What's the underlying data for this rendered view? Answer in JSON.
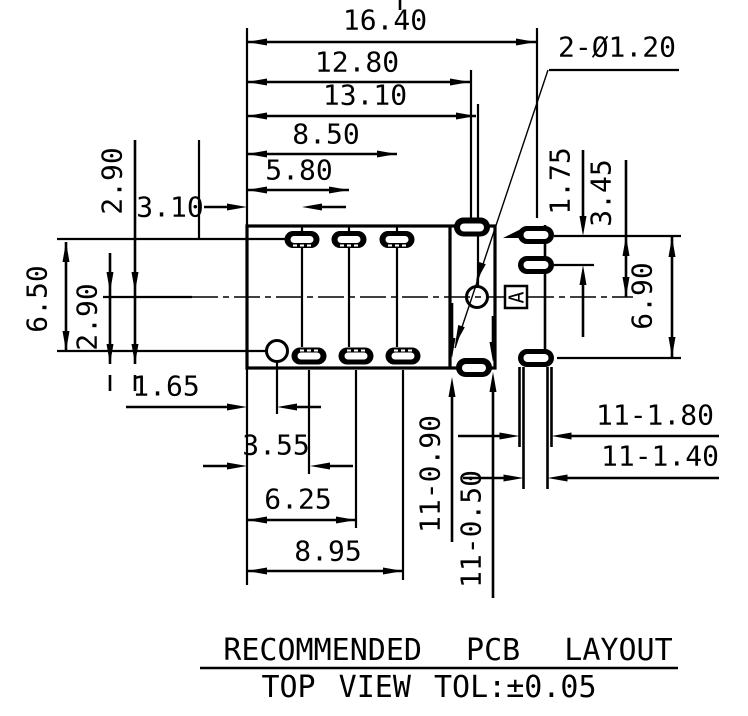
{
  "note": {
    "title": "RECOMMENDED PCB LAYOUT",
    "subtitle": "TOP VIEW TOL:±0.05"
  },
  "callouts": {
    "holes": "2-Ø1.20",
    "datum": "A"
  },
  "dims": {
    "overall_width": "16.40",
    "pad_col_right": "12.80",
    "hole_x": "13.10",
    "top_pad3_x": "8.50",
    "top_pad2_x": "5.80",
    "top_pad1_x": "3.10",
    "row_offset_top": "2.90",
    "row_span": "6.50",
    "row_offset_bottom": "2.90",
    "hole2_x": "1.65",
    "bot_pad1_x": "3.55",
    "bot_pad2_x": "6.25",
    "bot_pad3_x": "8.95",
    "right_pad_pitch": "1.75",
    "right_pad_to_center": "3.45",
    "right_span": "6.90",
    "slot_outer_height": "11-0.90",
    "slot_inner_height": "11-0.50",
    "pad_outer_width": "11-1.80",
    "pad_inner_width": "11-1.40"
  }
}
